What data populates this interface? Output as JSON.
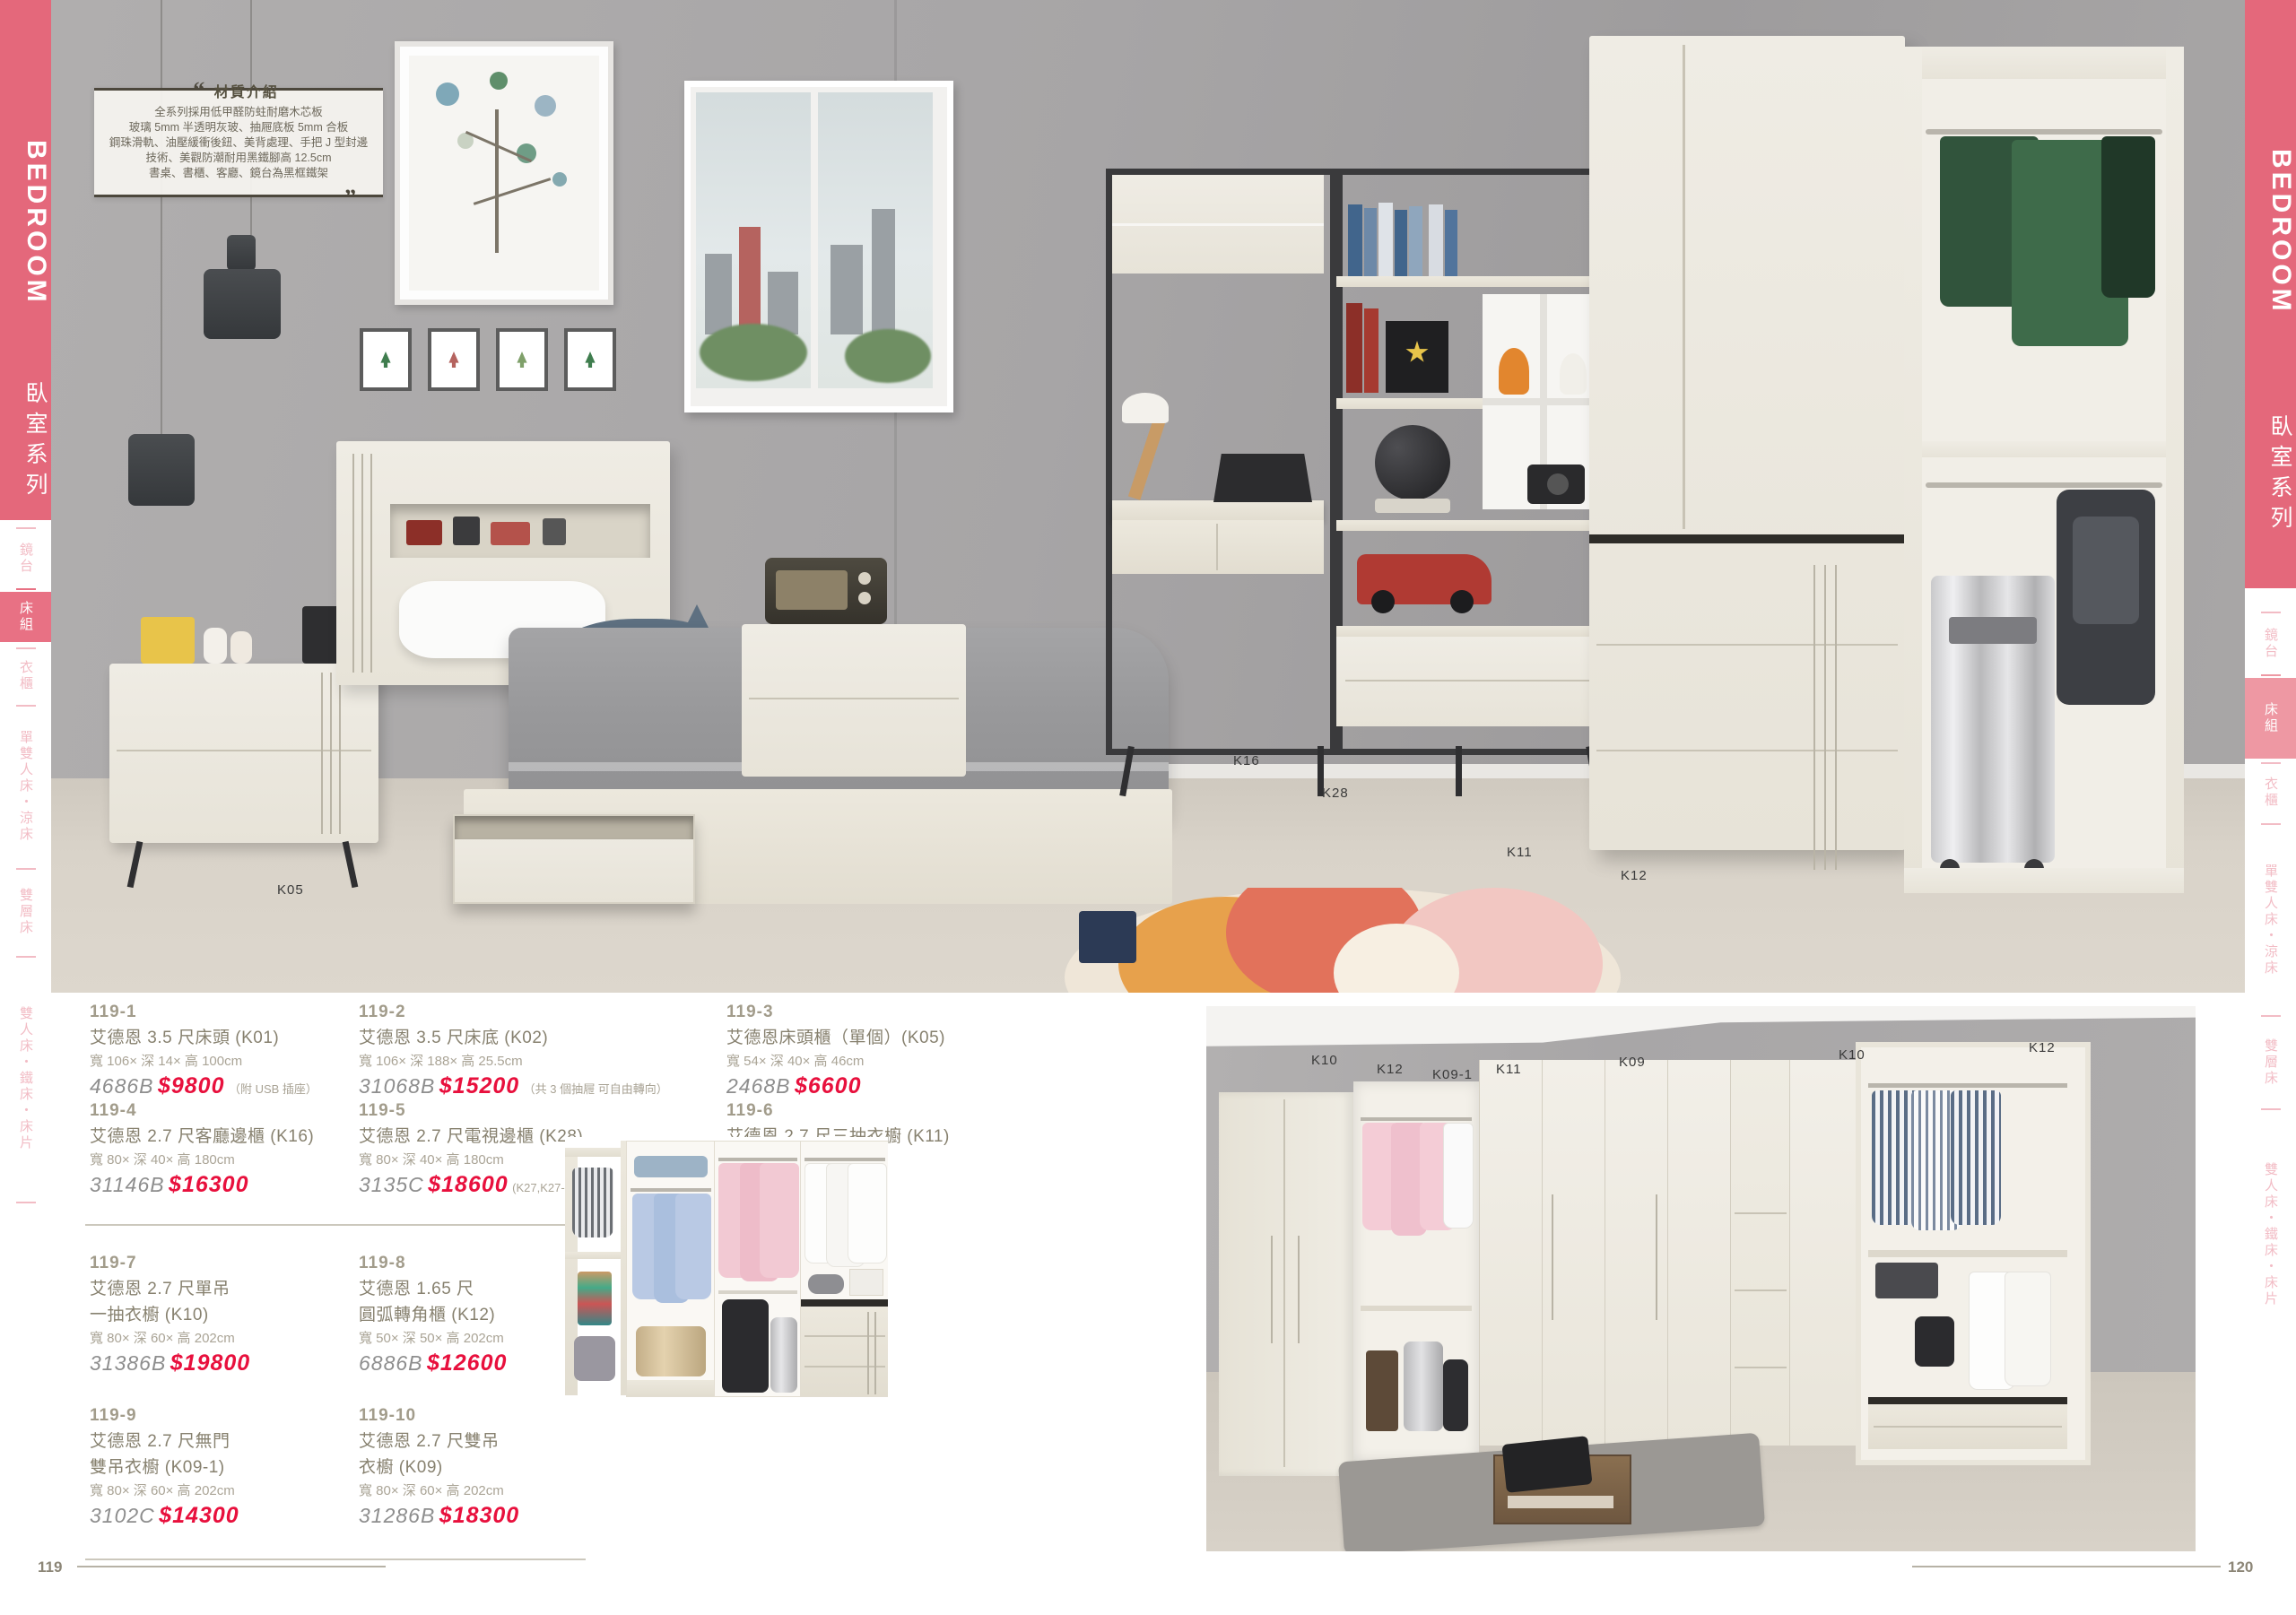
{
  "banner": {
    "title": "BEDROOM",
    "subtitle": "臥室系列"
  },
  "side_tabs": {
    "items": [
      {
        "label": "鏡台",
        "active": false
      },
      {
        "label": "床組",
        "active": true
      },
      {
        "label": "衣櫃",
        "active": false
      },
      {
        "label": "單雙人床・涼床",
        "active": false
      },
      {
        "label": "雙層床",
        "active": false
      },
      {
        "label": "雙人床・鐵床・床片",
        "active": false
      }
    ]
  },
  "material_info": {
    "title": "材質介紹",
    "lines": [
      "全系列採用低甲醛防蛀耐磨木芯板",
      "玻璃 5mm 半透明灰玻、抽屜底板 5mm 合板",
      "鋼珠滑軌、油壓緩衝後鈕、美背處理、手把 J 型封邊",
      "技術、美觀防潮耐用黑鐵腳高 12.5cm",
      "書桌、書櫃、客廳、鏡台為黑框鐵架"
    ]
  },
  "photo_labels": {
    "top": [
      "K05",
      "K16",
      "K28",
      "K11",
      "K12"
    ],
    "right": [
      "K10",
      "K12",
      "K09-1",
      "K11",
      "K09",
      "K10",
      "K12"
    ]
  },
  "products": [
    {
      "number": "119-1",
      "name": "艾德恩 3.5 尺床頭 (K01)",
      "dims": "寬 106× 深 14× 高 100cm",
      "code": "4686B",
      "price": "$9800",
      "note": "（附 USB 插座）"
    },
    {
      "number": "119-2",
      "name": "艾德恩 3.5 尺床底 (K02)",
      "dims": "寬 106× 深 188× 高 25.5cm",
      "code": "31068B",
      "price": "$15200",
      "note": "（共 3 個抽屜 可自由轉向）"
    },
    {
      "number": "119-3",
      "name": "艾德恩床頭櫃（單個）(K05)",
      "dims": "寬 54× 深 40× 高 46cm",
      "code": "2468B",
      "price": "$6600",
      "note": ""
    },
    {
      "number": "119-4",
      "name": "艾德恩 2.7 尺客廳邊櫃 (K16)",
      "dims": "寬 80× 深 40× 高 180cm",
      "code": "31146B",
      "price": "$16300",
      "note": ""
    },
    {
      "number": "119-5",
      "name": "艾德恩 2.7 尺電視邊櫃 (K28)",
      "dims": "寬 80× 深 40× 高 180cm",
      "code": "3135C",
      "price": "$18600",
      "note": "(K27,K27-1)"
    },
    {
      "number": "119-6",
      "name": "艾德恩 2.7 尺三抽衣櫥 (K11)",
      "dims": "寬 80× 深 60× 高 202cm",
      "code": "3157C",
      "price": "$21500",
      "note": ""
    },
    {
      "number": "119-7",
      "name": "艾德恩 2.7 尺單吊",
      "name2": "一抽衣櫥 (K10)",
      "dims": "寬 80× 深 60× 高 202cm",
      "code": "31386B",
      "price": "$19800",
      "note": ""
    },
    {
      "number": "119-8",
      "name": "艾德恩 1.65 尺",
      "name2": "圓弧轉角櫃 (K12)",
      "dims": "寬 50× 深 50× 高 202cm",
      "code": "6886B",
      "price": "$12600",
      "note": ""
    },
    {
      "number": "119-9",
      "name": "艾德恩 2.7 尺無門",
      "name2": "雙吊衣櫥 (K09-1)",
      "dims": "寬 80× 深 60× 高 202cm",
      "code": "3102C",
      "price": "$14300",
      "note": ""
    },
    {
      "number": "119-10",
      "name": "艾德恩 2.7 尺雙吊",
      "name2": "衣櫥 (K09)",
      "dims": "寬 80× 深 60× 高 202cm",
      "code": "31286B",
      "price": "$18300",
      "note": ""
    }
  ],
  "pages": {
    "left": "119",
    "right": "120"
  },
  "colors": {
    "accent_pink": "#e4687b",
    "active_tab_left": "#e87184",
    "active_tab_right": "#ee98a3",
    "price_red": "#e8103d"
  }
}
